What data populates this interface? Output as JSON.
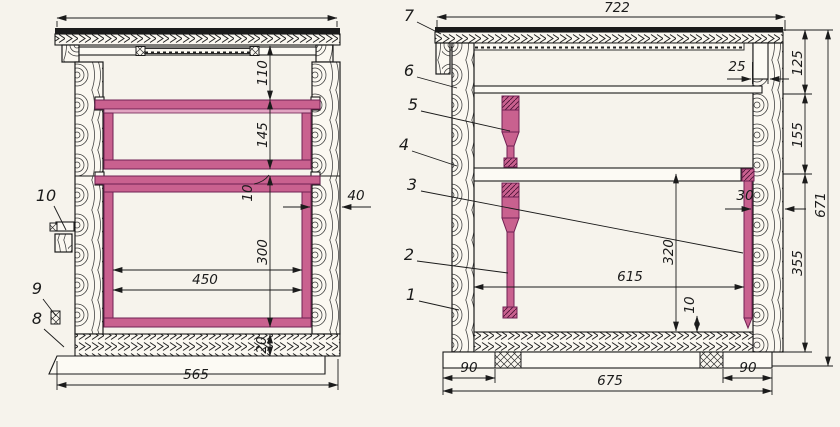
{
  "colors": {
    "frame-pink": "#c9618f",
    "frame-dark": "#702153",
    "frame-light": "#e2a4c2",
    "ink": "#1b1b1b",
    "paper": "#f6f3ec"
  },
  "left_view": {
    "name": "cross-section",
    "dims": {
      "inner_top_space": "110",
      "super_frame_height": "145",
      "frame_gap": "10",
      "nest_frame_height": "300",
      "frame_width": "450",
      "floor_thickness": "20",
      "overall_width": "565",
      "wall_thickness": "40"
    },
    "callouts": {
      "entrance_latch": "10",
      "entrance_block": "9",
      "bottom_board": "8"
    }
  },
  "right_view": {
    "name": "longitudinal-section",
    "dims": {
      "roof_width": "722",
      "roof_rabbet": "25",
      "roof_section_height": "125",
      "super_section_height": "155",
      "wall_thickness": "30",
      "body_section_height": "355",
      "overall_height": "671",
      "inner_height": "320",
      "inner_length": "615",
      "bottom_clearance": "10",
      "foot_offset_left": "90",
      "floor_length": "675",
      "foot_offset_right": "90"
    },
    "callouts": {
      "roof": "7",
      "inner_cover": "6",
      "super_frame": "5",
      "side_wall": "4",
      "division_board": "3",
      "nest_frame": "2",
      "hive_body": "1"
    }
  }
}
